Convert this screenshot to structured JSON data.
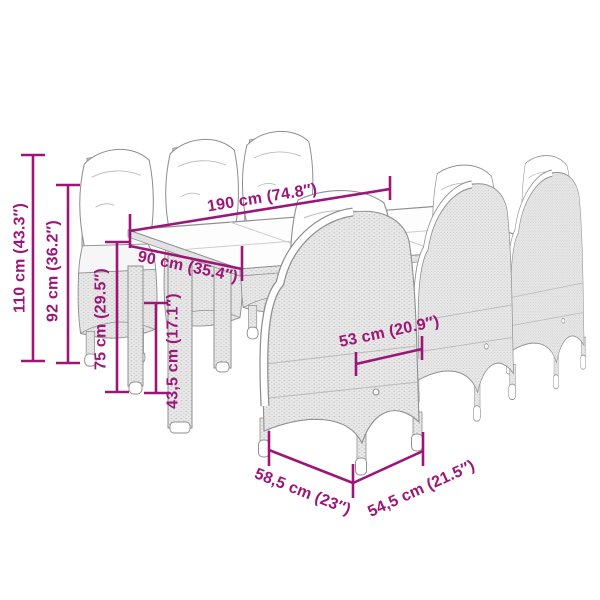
{
  "page": {
    "background": "#ffffff"
  },
  "diagram": {
    "description": "Dimension diagram of a poly-rattan garden dining set: glass-top table with six high-back cushioned chairs",
    "accent_color": "#9c1678",
    "outline_color": "#8f8f8f",
    "rattan_base_color": "#e9e9e9",
    "rattan_dot_color": "#c3c3c3",
    "dimensions": {
      "total_height": "110 cm (43.3″)",
      "backrest_height": "92 cm (36.2″)",
      "table_height": "75 cm (29.5″)",
      "seat_height": "43,5 cm (17.1″)",
      "table_length": "190 cm (74.8″)",
      "table_depth": "90 cm (35.4″)",
      "seat_width": "53 cm (20.9″)",
      "chair_depth": "58,5 cm (23″)",
      "chair_width": "54,5 cm (21.5″)"
    }
  }
}
